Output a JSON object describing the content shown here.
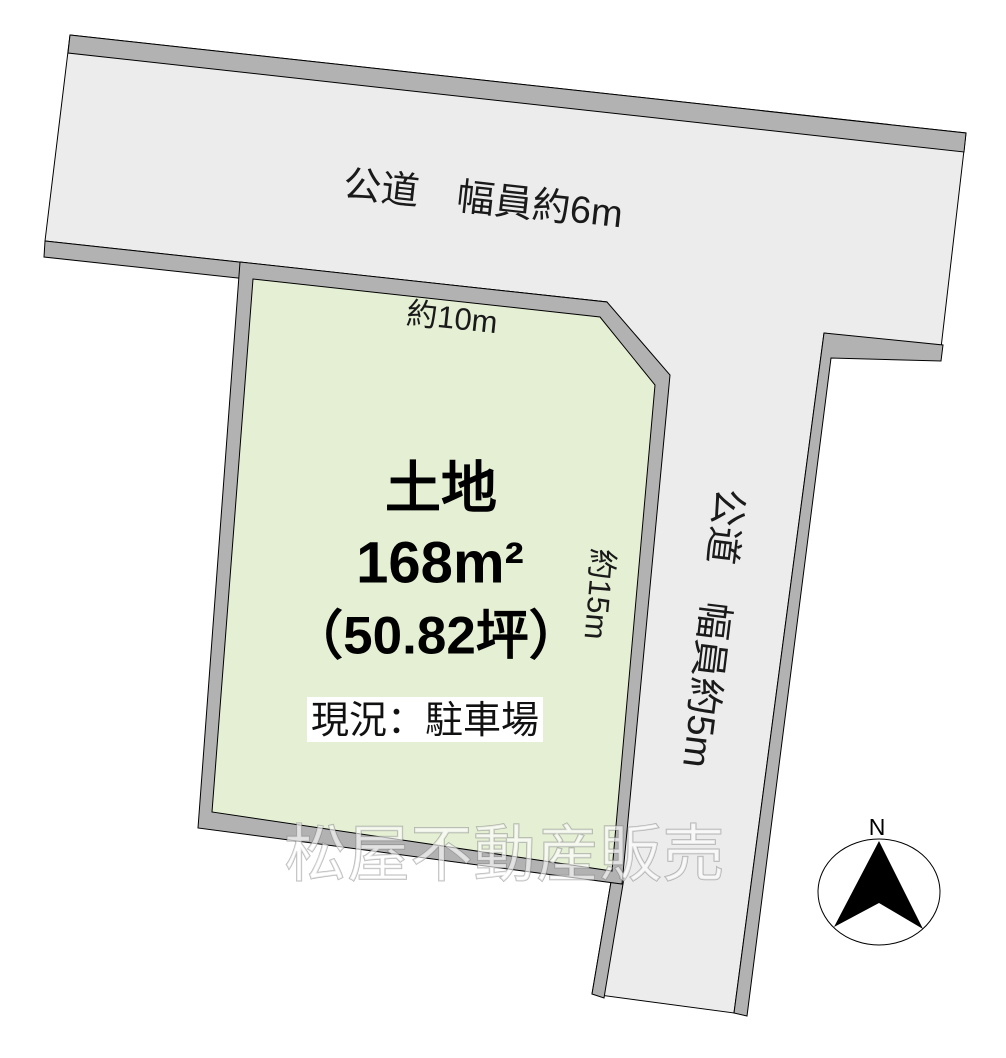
{
  "colors": {
    "road_surface": "#ececec",
    "border_band": "#b2b2b2",
    "parcel_fill": "#e4efd3",
    "status_box": "#ffffff",
    "needle": "#000000"
  },
  "roads": {
    "horizontal_label": "公道　幅員約6m",
    "vertical_label": "公道　幅員約5m"
  },
  "parcel": {
    "title": "土地",
    "area_m2": "168m²",
    "area_tsubo": "（50.82坪）",
    "status": "現況：駐車場",
    "frontage_label": "約10m",
    "depth_label": "約15m"
  },
  "watermark": "松屋不動産販売",
  "compass": {
    "north_label": "N"
  }
}
